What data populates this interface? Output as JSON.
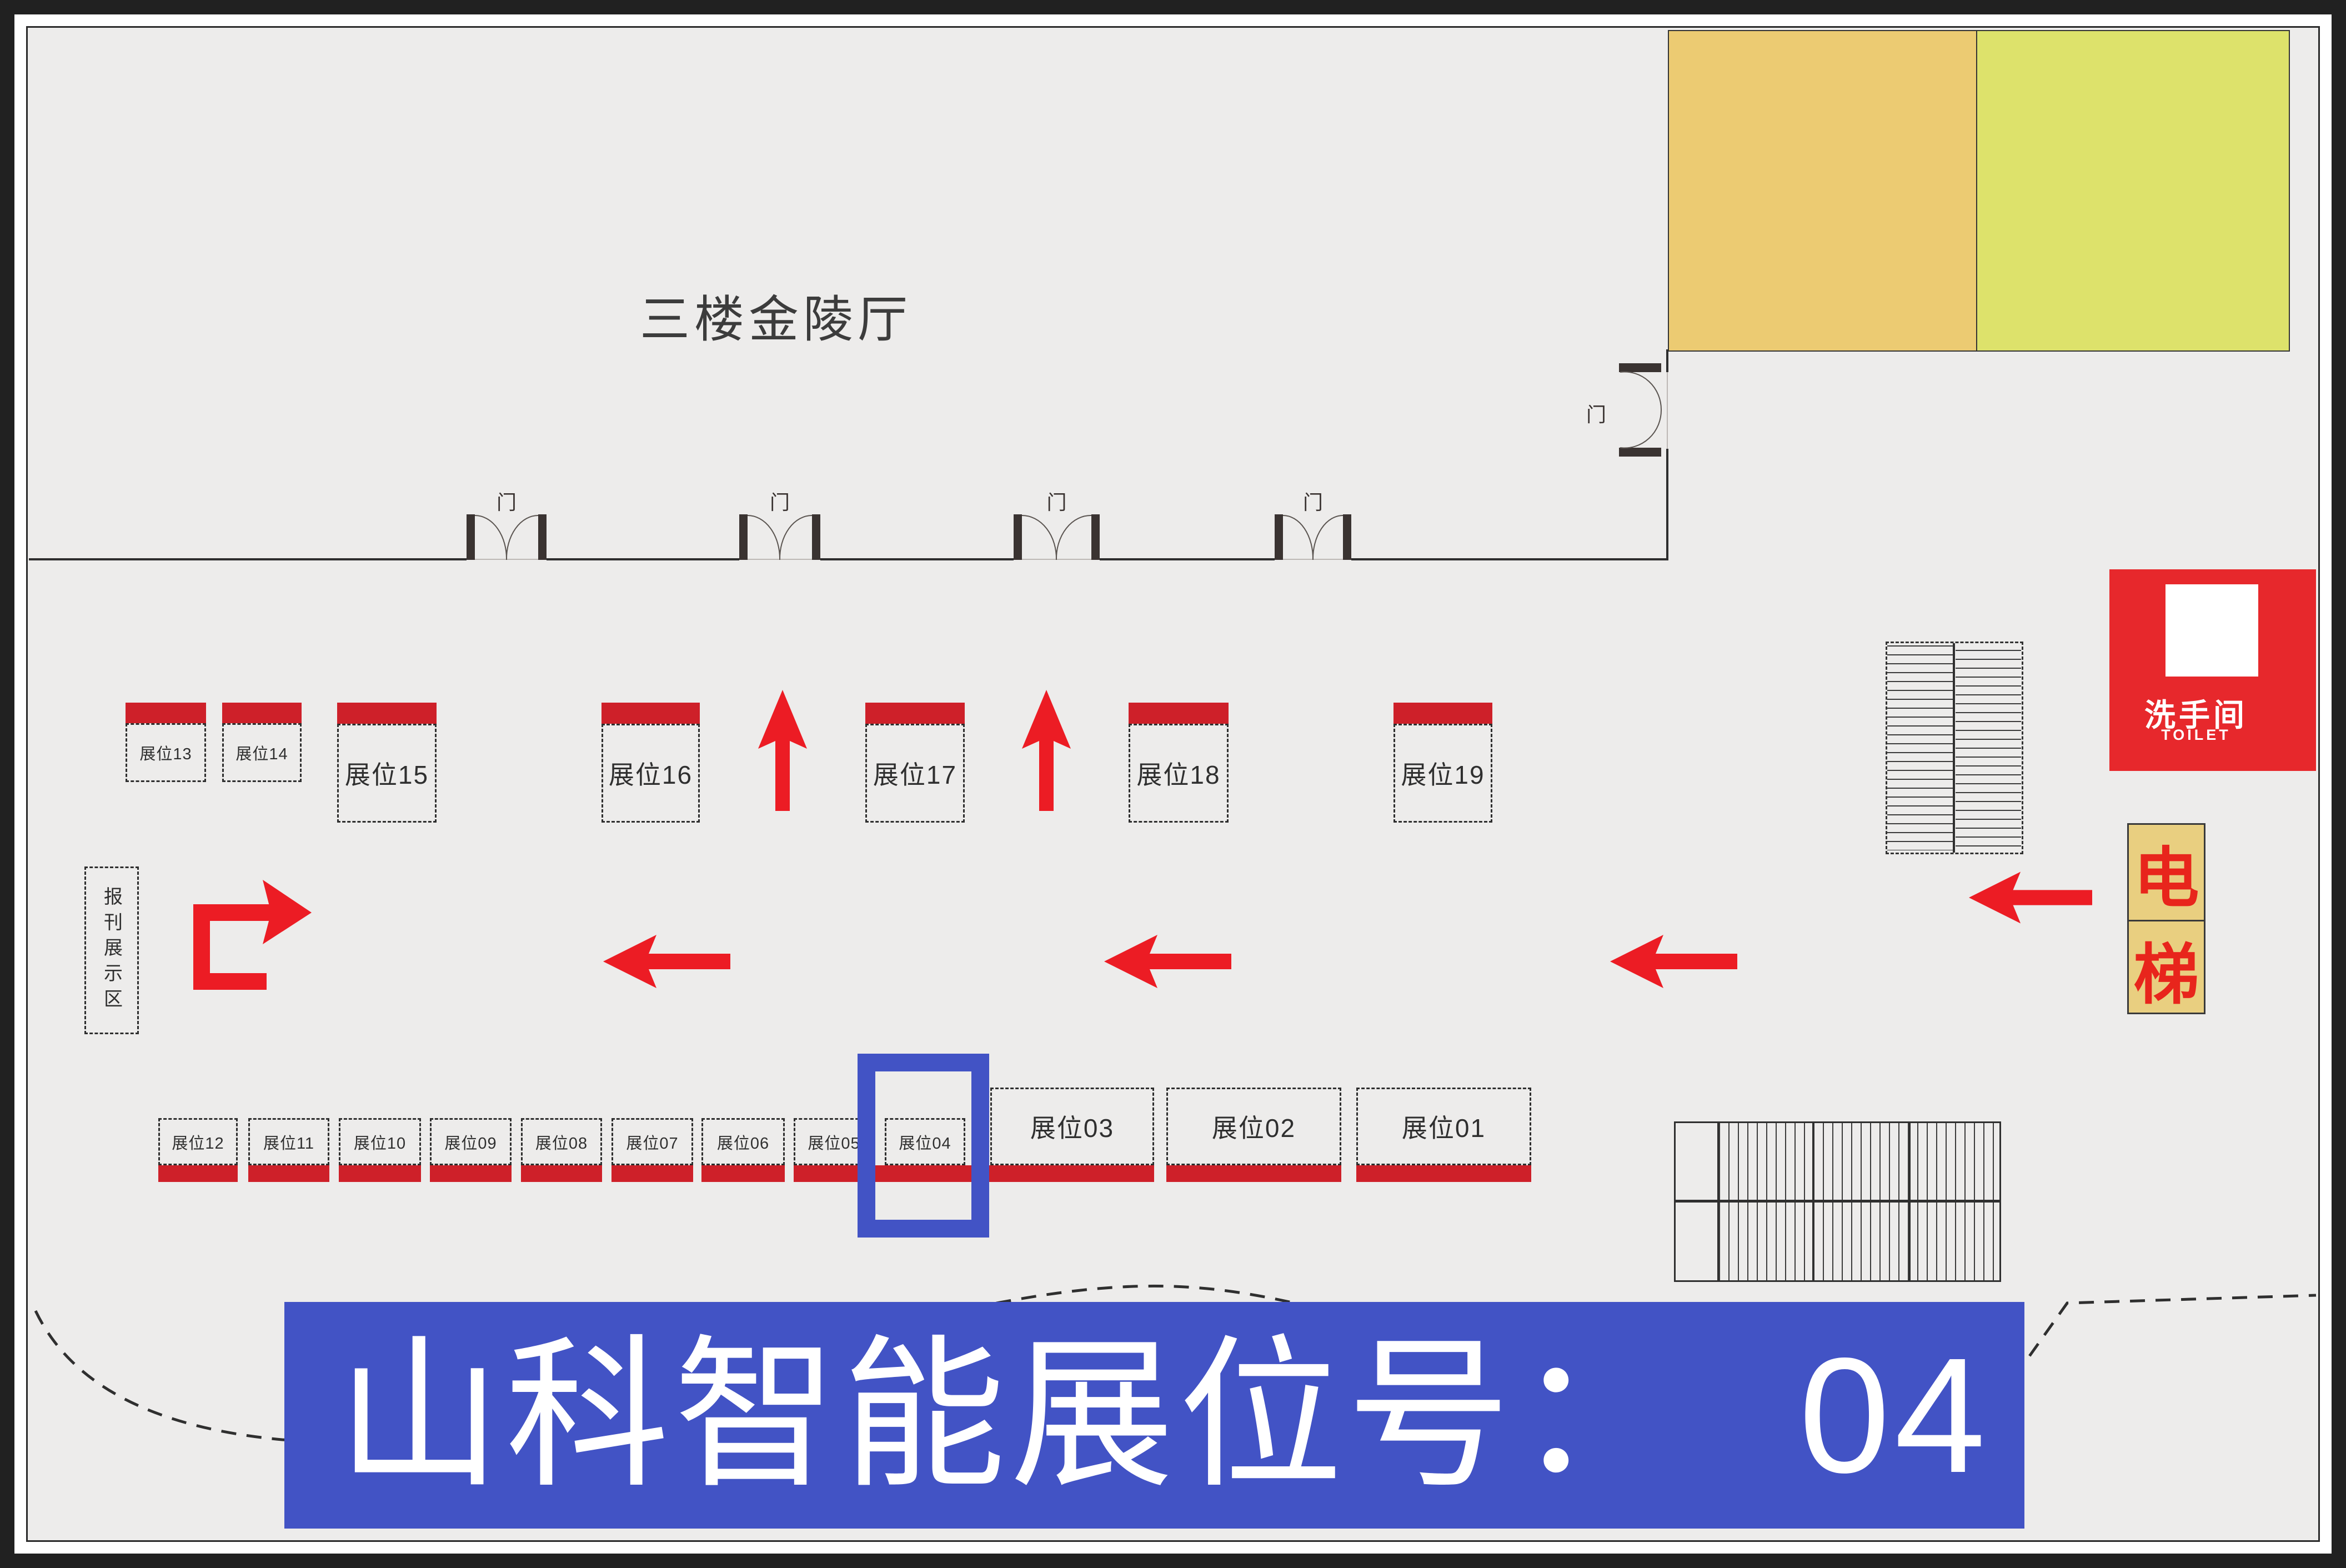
{
  "title": "三楼金陵厅",
  "door_label": "门",
  "news_area_label": "报刊展示区",
  "toilet": {
    "cn": "洗手间",
    "en": "TOILET"
  },
  "elevator": {
    "top": "电",
    "bottom": "梯"
  },
  "banner": {
    "prefix": "山科智能展位号：",
    "number": "04"
  },
  "highlight_booth": "展位04",
  "booths": {
    "top": [
      {
        "label": "展位13"
      },
      {
        "label": "展位14"
      },
      {
        "label": "展位15"
      },
      {
        "label": "展位16"
      },
      {
        "label": "展位17"
      },
      {
        "label": "展位18"
      },
      {
        "label": "展位19"
      }
    ],
    "bottom": [
      {
        "label": "展位12"
      },
      {
        "label": "展位11"
      },
      {
        "label": "展位10"
      },
      {
        "label": "展位09"
      },
      {
        "label": "展位08"
      },
      {
        "label": "展位07"
      },
      {
        "label": "展位06"
      },
      {
        "label": "展位05"
      },
      {
        "label": "展位04"
      },
      {
        "label": "展位03"
      },
      {
        "label": "展位02"
      },
      {
        "label": "展位01"
      }
    ]
  },
  "colors": {
    "booth_bar_red": "#ce2029",
    "arrow_red": "#ec1c24",
    "toilet_red": "#e7282c",
    "elevator_bg": "#e9cf80",
    "room_yellow": "#eccb72",
    "room_green": "#dde26b",
    "highlight_blue": "#4253c5",
    "banner_blue": "#4253c5",
    "wall": "#2e2e2e",
    "background": "#edeceb"
  }
}
